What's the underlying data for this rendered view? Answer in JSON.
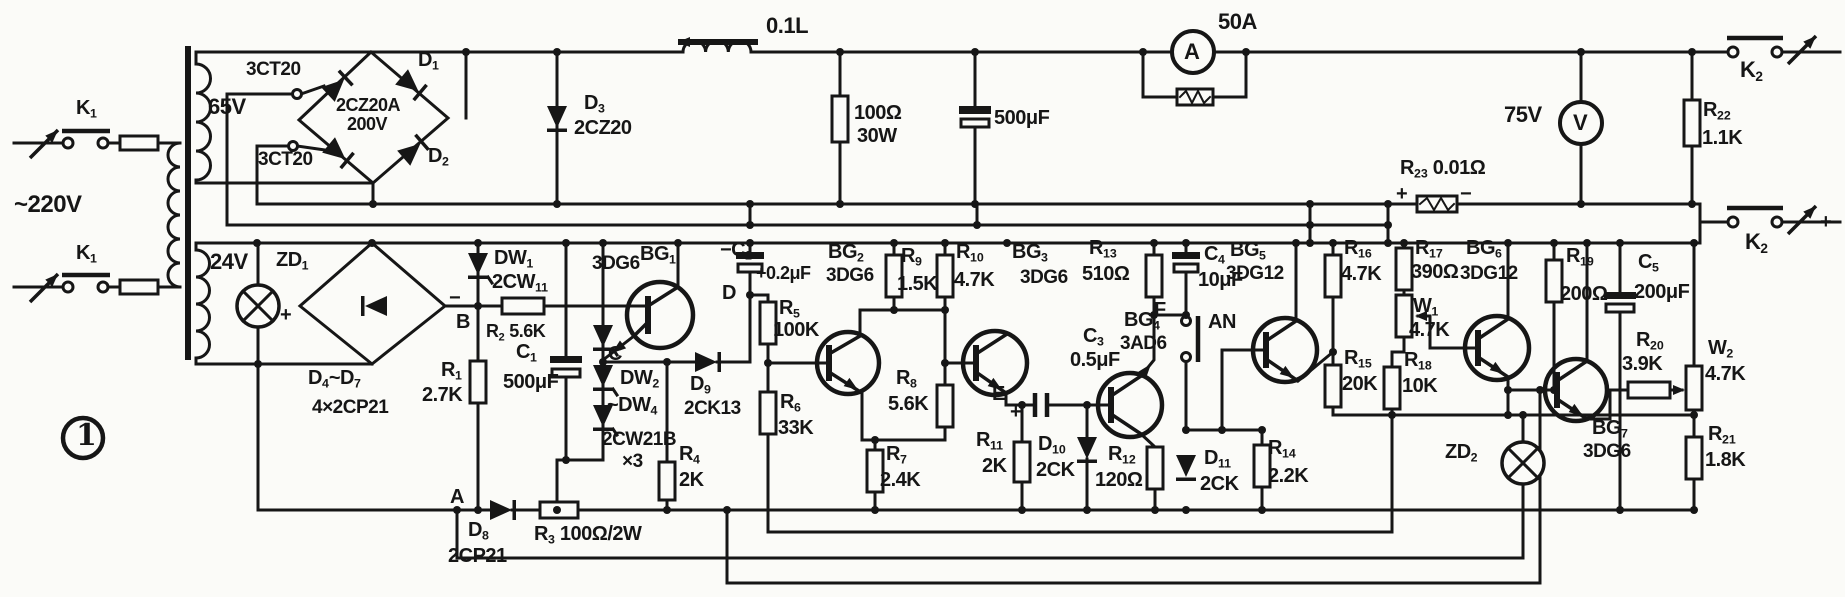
{
  "figure": {
    "number": "1"
  },
  "colors": {
    "ink": "#161616",
    "paper": "#fbfbf8"
  },
  "meters": {
    "ammeter": "A",
    "voltmeter": "V"
  },
  "labels": {
    "k1_top": {
      "a": "K",
      "s": "1"
    },
    "k1_bot": {
      "a": "K",
      "s": "1"
    },
    "v220": {
      "a": "~220V"
    },
    "v65": {
      "a": "65V"
    },
    "ct3_top": {
      "a": "3CT20"
    },
    "ct3_bot": {
      "a": "3CT20"
    },
    "d1": {
      "a": "D",
      "s": "1"
    },
    "d2": {
      "a": "D",
      "s": "2"
    },
    "br1": {
      "a": "2CZ20A"
    },
    "br1v": {
      "a": "200V"
    },
    "d3": {
      "a": "D",
      "s": "3"
    },
    "d3t": {
      "a": "2CZ20"
    },
    "ind": {
      "a": "0.1L"
    },
    "r100": {
      "a": "100Ω"
    },
    "r100w": {
      "a": "30W"
    },
    "c500": {
      "a": "500μF"
    },
    "a50": {
      "a": "50A"
    },
    "v75": {
      "a": "75V"
    },
    "r22": {
      "a": "R",
      "s": "22"
    },
    "r22v": {
      "a": "1.1K"
    },
    "k2_top": {
      "a": "K",
      "s": "2"
    },
    "k2_bot": {
      "a": "K",
      "s": "2"
    },
    "k2bp": {
      "a": "+"
    },
    "r23": {
      "a": "R",
      "s": "23",
      "b": " 0.01Ω"
    },
    "r23p": {
      "a": "+"
    },
    "r23m": {
      "a": "−"
    },
    "v24": {
      "a": "24V"
    },
    "zd1": {
      "a": "ZD",
      "s": "1"
    },
    "plus1": {
      "a": "+"
    },
    "minus1": {
      "a": "−"
    },
    "d47": {
      "a": "D",
      "s": "4",
      "b": "~D",
      "s2": "7"
    },
    "d47v": {
      "a": "4×2CP21"
    },
    "bnode": {
      "a": "B"
    },
    "anode": {
      "a": "A"
    },
    "cnode": {
      "a": "C"
    },
    "dnode": {
      "a": "D"
    },
    "enode": {
      "a": "E"
    },
    "fnode": {
      "a": "F"
    },
    "r1": {
      "a": "R",
      "s": "1"
    },
    "r1v": {
      "a": "2.7K"
    },
    "dw1": {
      "a": "DW",
      "s": "1"
    },
    "dw1v": {
      "a": "2CW",
      "s": "11"
    },
    "r2": {
      "a": "R",
      "s": "2",
      "b": " 5.6K"
    },
    "c1": {
      "a": "C",
      "s": "1"
    },
    "c1v": {
      "a": "500μF"
    },
    "d8": {
      "a": "D",
      "s": "8"
    },
    "d8v": {
      "a": "2CP21"
    },
    "r3": {
      "a": "R",
      "s": "3",
      "b": " 100Ω/2W"
    },
    "dw2": {
      "a": "DW",
      "s": "2"
    },
    "dw4": {
      "a": "~DW",
      "s": "4"
    },
    "dwv": {
      "a": "2CW21B"
    },
    "dwx": {
      "a": "×3"
    },
    "bg1t": {
      "a": "3DG6"
    },
    "bg1": {
      "a": "BG",
      "s": "1"
    },
    "d9": {
      "a": "D",
      "s": "9"
    },
    "d9v": {
      "a": "2CK13"
    },
    "r4": {
      "a": "R",
      "s": "4"
    },
    "r4v": {
      "a": "2K"
    },
    "c2": {
      "a": "−C",
      "s": "2"
    },
    "c2v": {
      "a": "+0.2μF"
    },
    "r5": {
      "a": "R",
      "s": "5"
    },
    "r5v": {
      "a": "100K"
    },
    "r6": {
      "a": "R",
      "s": "6"
    },
    "r6v": {
      "a": "33K"
    },
    "bg2": {
      "a": "BG",
      "s": "2"
    },
    "bg2t": {
      "a": "3DG6"
    },
    "r7": {
      "a": "R",
      "s": "7"
    },
    "r7v": {
      "a": "2.4K"
    },
    "r8": {
      "a": "R",
      "s": "8"
    },
    "r8v": {
      "a": "5.6K"
    },
    "r9": {
      "a": "R",
      "s": "9"
    },
    "r9v": {
      "a": "1.5K"
    },
    "r10": {
      "a": "R",
      "s": "10"
    },
    "r10v": {
      "a": "4.7K"
    },
    "bg3": {
      "a": "BG",
      "s": "3"
    },
    "bg3t": {
      "a": "3DG6"
    },
    "c3": {
      "a": "C",
      "s": "3"
    },
    "c3v": {
      "a": "0.5μF"
    },
    "c3p": {
      "a": "+"
    },
    "c3m": {
      "a": "−"
    },
    "r11": {
      "a": "R",
      "s": "11"
    },
    "r11v": {
      "a": "2K"
    },
    "d10": {
      "a": "D",
      "s": "10"
    },
    "d10v": {
      "a": "2CK"
    },
    "bg4": {
      "a": "BG",
      "s": "4"
    },
    "bg4t": {
      "a": "3AD6"
    },
    "r12": {
      "a": "R",
      "s": "12"
    },
    "r12v": {
      "a": "120Ω"
    },
    "r13": {
      "a": "R",
      "s": "13"
    },
    "r13v": {
      "a": "510Ω"
    },
    "c4": {
      "a": "C",
      "s": "4"
    },
    "c4v": {
      "a": "10μF"
    },
    "an": {
      "a": "AN"
    },
    "d11": {
      "a": "D",
      "s": "11"
    },
    "d11v": {
      "a": "2CK"
    },
    "r14": {
      "a": "R",
      "s": "14"
    },
    "r14v": {
      "a": "2.2K"
    },
    "bg5": {
      "a": "BG",
      "s": "5"
    },
    "bg5t": {
      "a": "3DG12"
    },
    "r16": {
      "a": "R",
      "s": "16"
    },
    "r16v": {
      "a": "4.7K"
    },
    "r15": {
      "a": "R",
      "s": "15"
    },
    "r15v": {
      "a": "20K"
    },
    "r17": {
      "a": "R",
      "s": "17"
    },
    "r17v": {
      "a": "390Ω"
    },
    "w1": {
      "a": "W",
      "s": "1"
    },
    "w1v": {
      "a": "4.7K"
    },
    "r18": {
      "a": "R",
      "s": "18"
    },
    "r18v": {
      "a": "10K"
    },
    "bg6": {
      "a": "BG",
      "s": "6"
    },
    "bg6t": {
      "a": "3DG12"
    },
    "r19": {
      "a": "R",
      "s": "19"
    },
    "r19v": {
      "a": "200Ω"
    },
    "c5": {
      "a": "C",
      "s": "5"
    },
    "c5v": {
      "a": "200μF"
    },
    "r20": {
      "a": "R",
      "s": "20"
    },
    "r20v": {
      "a": "3.9K"
    },
    "bg7": {
      "a": "BG",
      "s": "7"
    },
    "bg7t": {
      "a": "3DG6"
    },
    "zd2": {
      "a": "ZD",
      "s": "2"
    },
    "w2": {
      "a": "W",
      "s": "2"
    },
    "w2v": {
      "a": "4.7K"
    },
    "r21": {
      "a": "R",
      "s": "21"
    },
    "r21v": {
      "a": "1.8K"
    }
  }
}
